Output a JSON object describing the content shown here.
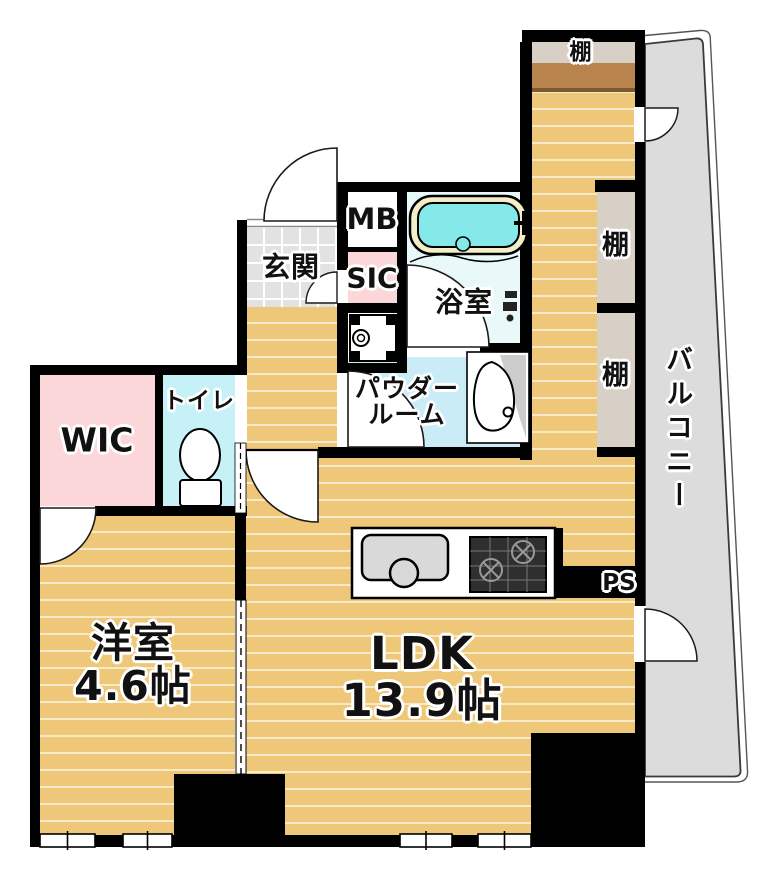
{
  "plan_title": "1LDK floor plan",
  "labels": {
    "shelf_top": "棚",
    "shelf_right_upper": "棚",
    "shelf_right_lower": "棚",
    "balcony": "バルコニー",
    "genkan": "玄関",
    "mb": "MB",
    "sic": "SIC",
    "bath": "浴室",
    "powder_line1": "パウダー",
    "powder_line2": "ルーム",
    "toilet": "トイレ",
    "wic": "WIC",
    "yoshitsu_name": "洋室",
    "yoshitsu_size": "4.6帖",
    "ldk_name": "LDK",
    "ldk_size": "13.9帖",
    "ps": "PS"
  },
  "colors": {
    "wall": "#000000",
    "wood": "#eec878",
    "tile": "#e2e2e2",
    "pink": "#fbd7da",
    "toilet_cyan": "#c6f2f7",
    "powder_blue": "#c9ecf7",
    "bath_floor": "#e9f8f8",
    "tub_rim": "#f2eec7",
    "tub_water": "#85e9e9",
    "shelf_beige": "#d8cfc7",
    "shelf_brown": "#b8834d",
    "shelf_brown_dark": "#7a5a2e",
    "balcony_gray": "#dcdcdc",
    "counter_gray": "#d9d9d9",
    "stove_dark": "#2f2f2f"
  }
}
